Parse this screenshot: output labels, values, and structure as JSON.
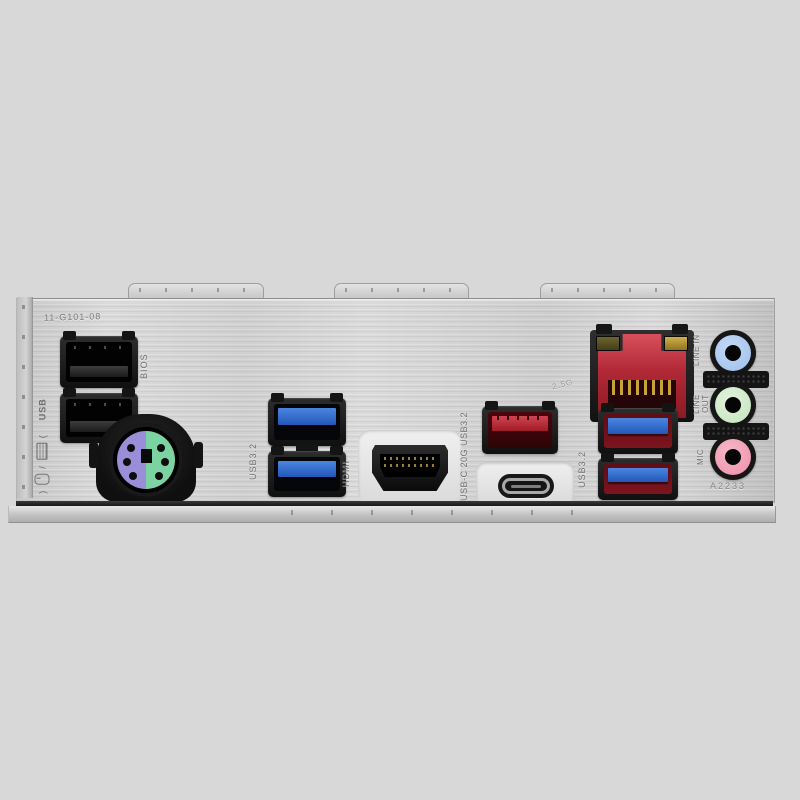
{
  "etched": {
    "part_number": "11-G101-08",
    "board_code": "A2233",
    "lan_speed": "2.5G"
  },
  "port_labels": {
    "kbms_usb": "USB",
    "kbms_slash": "/",
    "kbms_paren_open": "(",
    "kbms_paren_close": ")",
    "bios": "BIOS",
    "usb32_blue": "USB3.2",
    "hdmi": "HDMI",
    "usb_c": "USB-C 20G USB3.2",
    "usb32_red": "USB3.2",
    "line_in": "LINE IN",
    "line_out": "LINE OUT",
    "mic": "MIC"
  },
  "ports": [
    {
      "name": "usb2-port-1",
      "accent": "#141414"
    },
    {
      "name": "usb2-port-2",
      "accent": "#141414"
    },
    {
      "name": "ps2-combo-port",
      "accent": "#9a8ed8"
    },
    {
      "name": "usb32-blue-port-1",
      "accent": "#2f6fd0"
    },
    {
      "name": "usb32-blue-port-2",
      "accent": "#2f6fd0"
    },
    {
      "name": "hdmi-port",
      "accent": "#0b0b0b"
    },
    {
      "name": "usb32-red-type-a-port",
      "accent": "#b02836"
    },
    {
      "name": "usb-type-c-port",
      "accent": "#181818"
    },
    {
      "name": "lan-rj45-port",
      "accent": "#b02836"
    },
    {
      "name": "usb32-red-pair-port-1",
      "accent": "#7e141f"
    },
    {
      "name": "usb32-red-pair-port-2",
      "accent": "#7e141f"
    },
    {
      "name": "audio-line-in-jack",
      "accent": "#9dbfec"
    },
    {
      "name": "audio-line-out-jack",
      "accent": "#c4e4bc"
    },
    {
      "name": "audio-mic-jack",
      "accent": "#ee8fa8"
    }
  ],
  "colors": {
    "background": "#d8d8d8",
    "plate_metal": "#d6d6d6",
    "usb3_blue": "#2f6fd0",
    "lan_red": "#b02836",
    "red_usb_interior": "#7e141f",
    "ps2_keyboard_purple": "#9a8ed8",
    "ps2_mouse_green": "#7bd3a2",
    "audio_line_in_blue": "#9dbfec",
    "audio_line_out_green": "#c4e4bc",
    "audio_mic_pink": "#ee8fa8"
  }
}
